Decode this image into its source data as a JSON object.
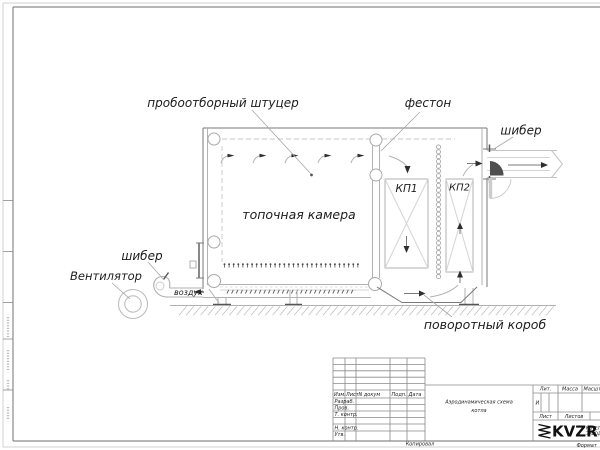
{
  "colors": {
    "ink": "#1b1b1b",
    "line": "#7a7a7a",
    "line_light": "#b5b5b5"
  },
  "diagram_labels": {
    "sampling_fitting": "пробоотборный штуцер",
    "festoon": "фестон",
    "damper_outlet": "шибер",
    "damper_fan": "шибер",
    "furnace_chamber": "топочная камера",
    "convective_package_1": "КП1",
    "convective_package_2": "КП2",
    "fan": "Вентилятор",
    "air": "воздух",
    "turning_duct": "поворотный короб"
  },
  "title_block": {
    "title_line1": "Аэродинамическая схема",
    "title_line2": "котла",
    "col_izm": "Изм.",
    "col_list": "Лист",
    "col_ndokum": "N докум",
    "col_podp": "Подп.",
    "col_data": "Дата",
    "row_razrab": "Разраб.",
    "row_prov": "Пров.",
    "row_tkontr": "Т. контр.",
    "row_nkontr": "Н. контр.",
    "row_utv": "Утв.",
    "lit_header": "Лит.",
    "lit_value": "И",
    "massa_header": "Масса",
    "masshtab_header": "Масштаб",
    "list_header": "Лист",
    "listov_header": "Листов",
    "logo": "KVZR",
    "company_line1": "КОТЕЛЬНЫЙ",
    "company_line2": "ЗАВОД",
    "copied": "Копировал",
    "format": "Формат"
  }
}
